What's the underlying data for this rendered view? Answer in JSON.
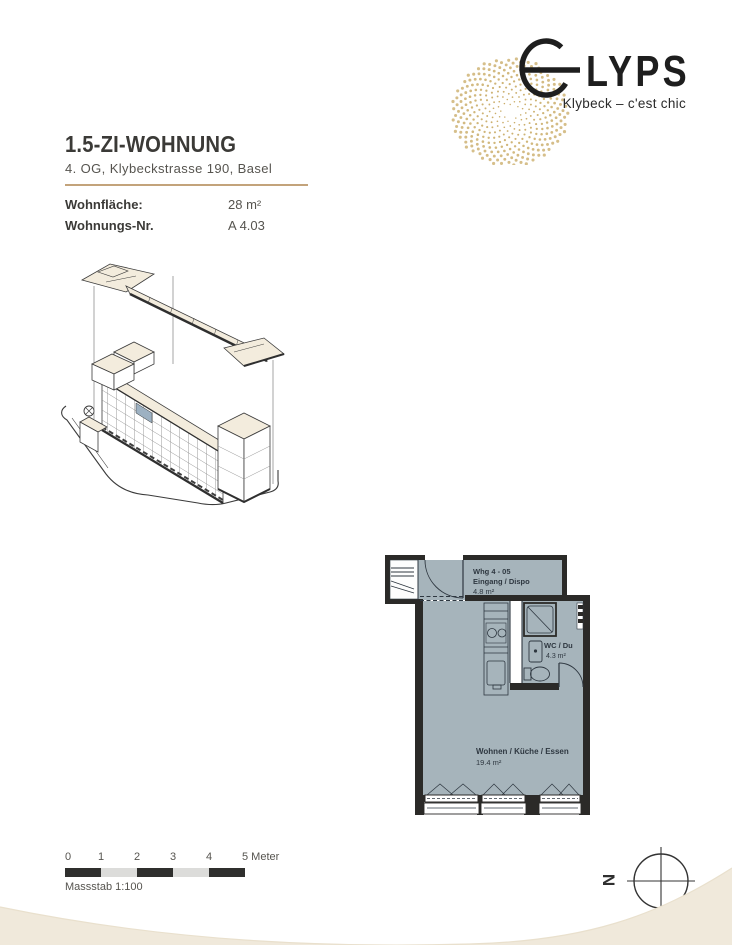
{
  "logo": {
    "full_name": "ELYPS",
    "wordmark_rest": "LYPS",
    "tagline": "Klybeck – c'est chic"
  },
  "header": {
    "title": "1.5-ZI-WOHNUNG",
    "address": "4. OG, Klybeckstrasse 190, Basel",
    "facts": [
      {
        "label": "Wohnfläche:",
        "value": "28 m²"
      },
      {
        "label": "Wohnungs-Nr.",
        "value": "A 4.03"
      }
    ]
  },
  "floorplan": {
    "unit_line1": "Whg 4 - 05",
    "unit_line2": "Eingang / Dispo",
    "unit_area": "4.8 m²",
    "bath_name": "WC / Du",
    "bath_area": "4.3 m²",
    "living_name": "Wohnen / Küche / Essen",
    "living_area": "19.4 m²"
  },
  "scalebar": {
    "ticks": [
      "0",
      "1",
      "2",
      "3",
      "4"
    ],
    "end_label": "5 Meter",
    "caption": "Massstab 1:100"
  },
  "compass": {
    "north_label": "N"
  },
  "colors": {
    "accent_gold": "#c3a37b",
    "floor_fill": "#a6b4bb",
    "wall": "#2b2a28",
    "roof_cream": "#f3ecdd",
    "highlight_unit": "#9db1c2",
    "swoosh": "#f0e9db",
    "spiral_dot": "#c2a052"
  }
}
